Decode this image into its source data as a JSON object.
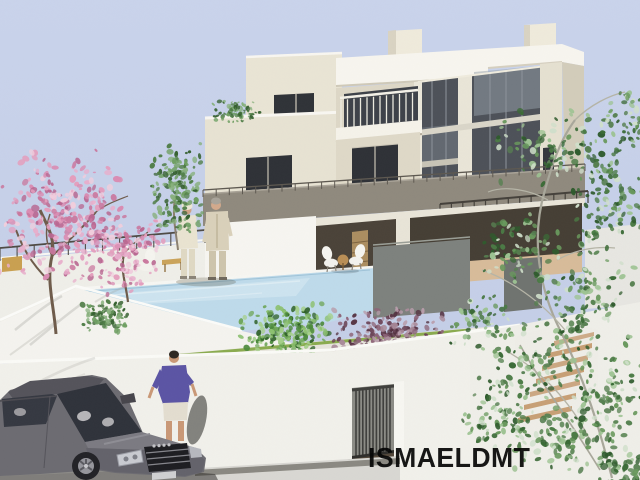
{
  "image": {
    "type": "3D architectural rendering of a modern hillside villa",
    "watermark": "ISMAELDMT"
  },
  "palette": {
    "sky": "#c6d0e8",
    "roof_white": "#f7f5ee",
    "wall_cream": "#e7e2d2",
    "wall_white": "#f4f3ee",
    "parapet_taupe": "#8f897d",
    "glass_dark": "#4d5158",
    "window_dark": "#2f3237",
    "pool_water": "#bedaea",
    "deck_tan": "#d7bb99",
    "street_gray": "#d8d7d2",
    "car_gray": "#6c6b71",
    "shirt_purple": "#5b54a4",
    "foliage": {
      "pink": [
        "#e8aecb",
        "#d98cb2",
        "#f0cddd",
        "#c9769d",
        "#e49ebd",
        "#b86690"
      ],
      "green": [
        "#4f7d46",
        "#6f9f63",
        "#35602f",
        "#87b07c"
      ],
      "green_bush": [
        "#4c8a3c",
        "#6da557",
        "#8cc06f",
        "#2f6128",
        "#a5cf8a"
      ],
      "tree_green": [
        "#4a7a44",
        "#68985c",
        "#2e5a2c",
        "#9cc291",
        "#cfdfca",
        "#567f50",
        "#3a6a36"
      ],
      "purple": [
        "#8d6478",
        "#6b4457",
        "#a98b9a",
        "#53303f",
        "#b89dab"
      ]
    }
  }
}
